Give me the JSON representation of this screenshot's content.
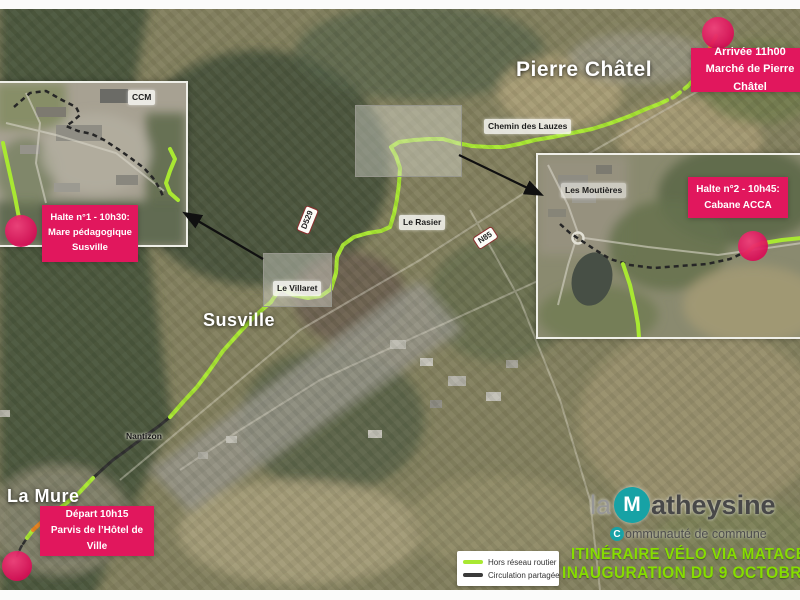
{
  "map": {
    "place_labels": {
      "pierre_chatel": "Pierre Châtel",
      "susville": "Susville",
      "la_mure": "La Mure",
      "le_rasier": "Le Rasier",
      "le_villaret": "Le Villaret",
      "nantizon": "Nantizon",
      "ccm": "CCM",
      "chemin_line1": "Chemin",
      "chemin_line2": "des Lauzes",
      "moutieres_line1": "Les",
      "moutieres_line2": "Moutières"
    },
    "road_labels": {
      "d529": "D529",
      "n85": "N85"
    }
  },
  "callouts": {
    "depart": {
      "line1": "Départ 10h15",
      "line2": "Parvis de l’Hôtel de Ville"
    },
    "halte1": {
      "line1": "Halte n°1 - 10h30:",
      "line2": "Mare pédagogique",
      "line3": "Susville"
    },
    "halte2": {
      "line1": "Halte n°2 - 10h45:",
      "line2": "Cabane ACCA"
    },
    "arrivee": {
      "line1": "Arrivée 11h00",
      "line2": "Marché de Pierre Châtel"
    }
  },
  "legend": {
    "items": [
      {
        "label": "Hors réseau routier",
        "color": "#a9e832"
      },
      {
        "label": "Circulation partagée",
        "color": "#3a3a3a"
      }
    ]
  },
  "title": {
    "line1": "ITINÉRAIRE VÉLO VIA MATACEN",
    "line2": "INAUGURATION DU 9 OCTOBRE 20",
    "color": "#86dd00"
  },
  "logo": {
    "prefix": "la",
    "m_letter": "M",
    "name_rest": "atheysine",
    "subtitle_c": "C",
    "subtitle_rest": "ommunauté de commune",
    "teal": "#17a2a5"
  },
  "colors": {
    "route_offroad_green": "#a9e832",
    "route_shared_black": "#2f2f2f",
    "route_orange": "#e8821e",
    "marker_pink": "#e1175d"
  }
}
